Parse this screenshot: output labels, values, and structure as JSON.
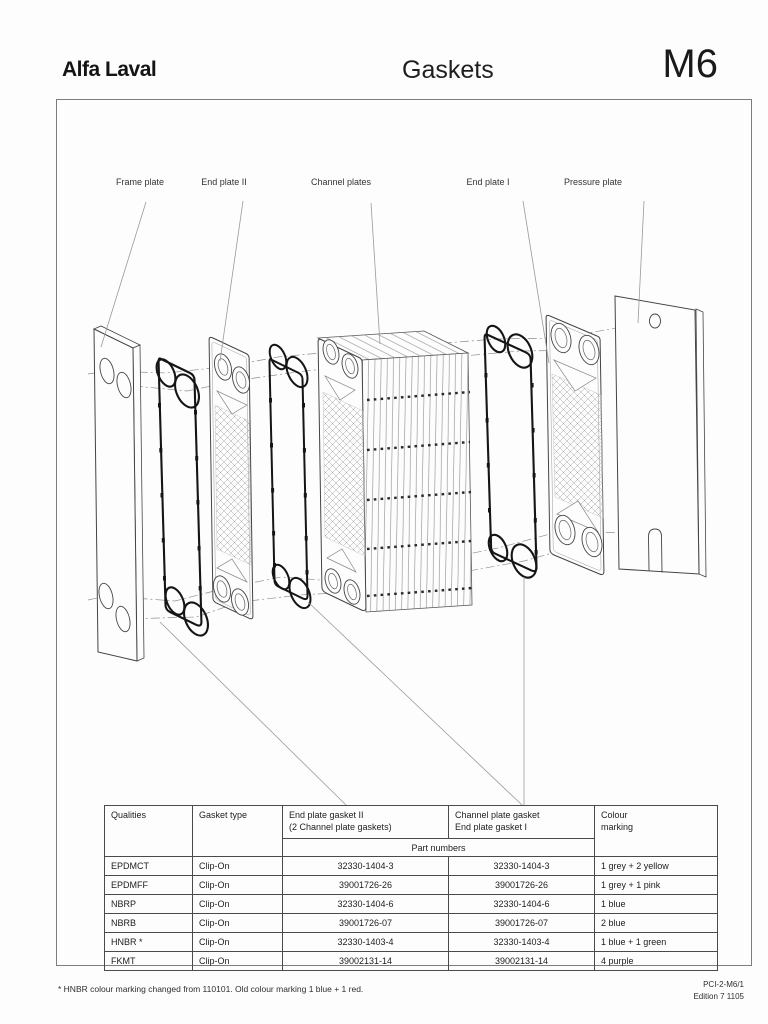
{
  "header": {
    "logo": "Alfa Laval",
    "title": "Gaskets",
    "model": "M6"
  },
  "diagram": {
    "labels": {
      "frame_plate": "Frame plate",
      "end_plate_2": "End plate II",
      "channel_plates": "Channel plates",
      "end_plate_1": "End plate I",
      "pressure_plate": "Pressure plate"
    }
  },
  "table": {
    "headers": {
      "qualities": "Qualities",
      "gasket_type": "Gasket type",
      "end_plate_gasket_2": "End plate  gasket II\n(2 Channel plate gaskets)",
      "channel_plate_gasket": "Channel plate gasket\nEnd plate gasket I",
      "colour_marking": "Colour\nmarking",
      "part_numbers": "Part numbers"
    },
    "rows": [
      {
        "quality": "EPDMCT",
        "type": "Clip-On",
        "part1": "32330-1404-3",
        "part2": "32330-1404-3",
        "colour": "1 grey + 2 yellow"
      },
      {
        "quality": "EPDMFF",
        "type": "Clip-On",
        "part1": "39001726-26",
        "part2": "39001726-26",
        "colour": "1 grey + 1 pink"
      },
      {
        "quality": "NBRP",
        "type": "Clip-On",
        "part1": "32330-1404-6",
        "part2": "32330-1404-6",
        "colour": "1 blue"
      },
      {
        "quality": "NBRB",
        "type": "Clip-On",
        "part1": "39001726-07",
        "part2": "39001726-07",
        "colour": "2 blue"
      },
      {
        "quality": "HNBR *",
        "type": "Clip-On",
        "part1": "32330-1403-4",
        "part2": "32330-1403-4",
        "colour": "1 blue + 1 green"
      },
      {
        "quality": "FKMT",
        "type": "Clip-On",
        "part1": "39002131-14",
        "part2": "39002131-14",
        "colour": "4 purple"
      }
    ]
  },
  "footer": {
    "footnote": "* HNBR colour marking changed from 110101. Old colour marking 1 blue + 1 red.",
    "doc_code": "PCI-2-M6/1",
    "edition": "Edition 7 1105"
  }
}
